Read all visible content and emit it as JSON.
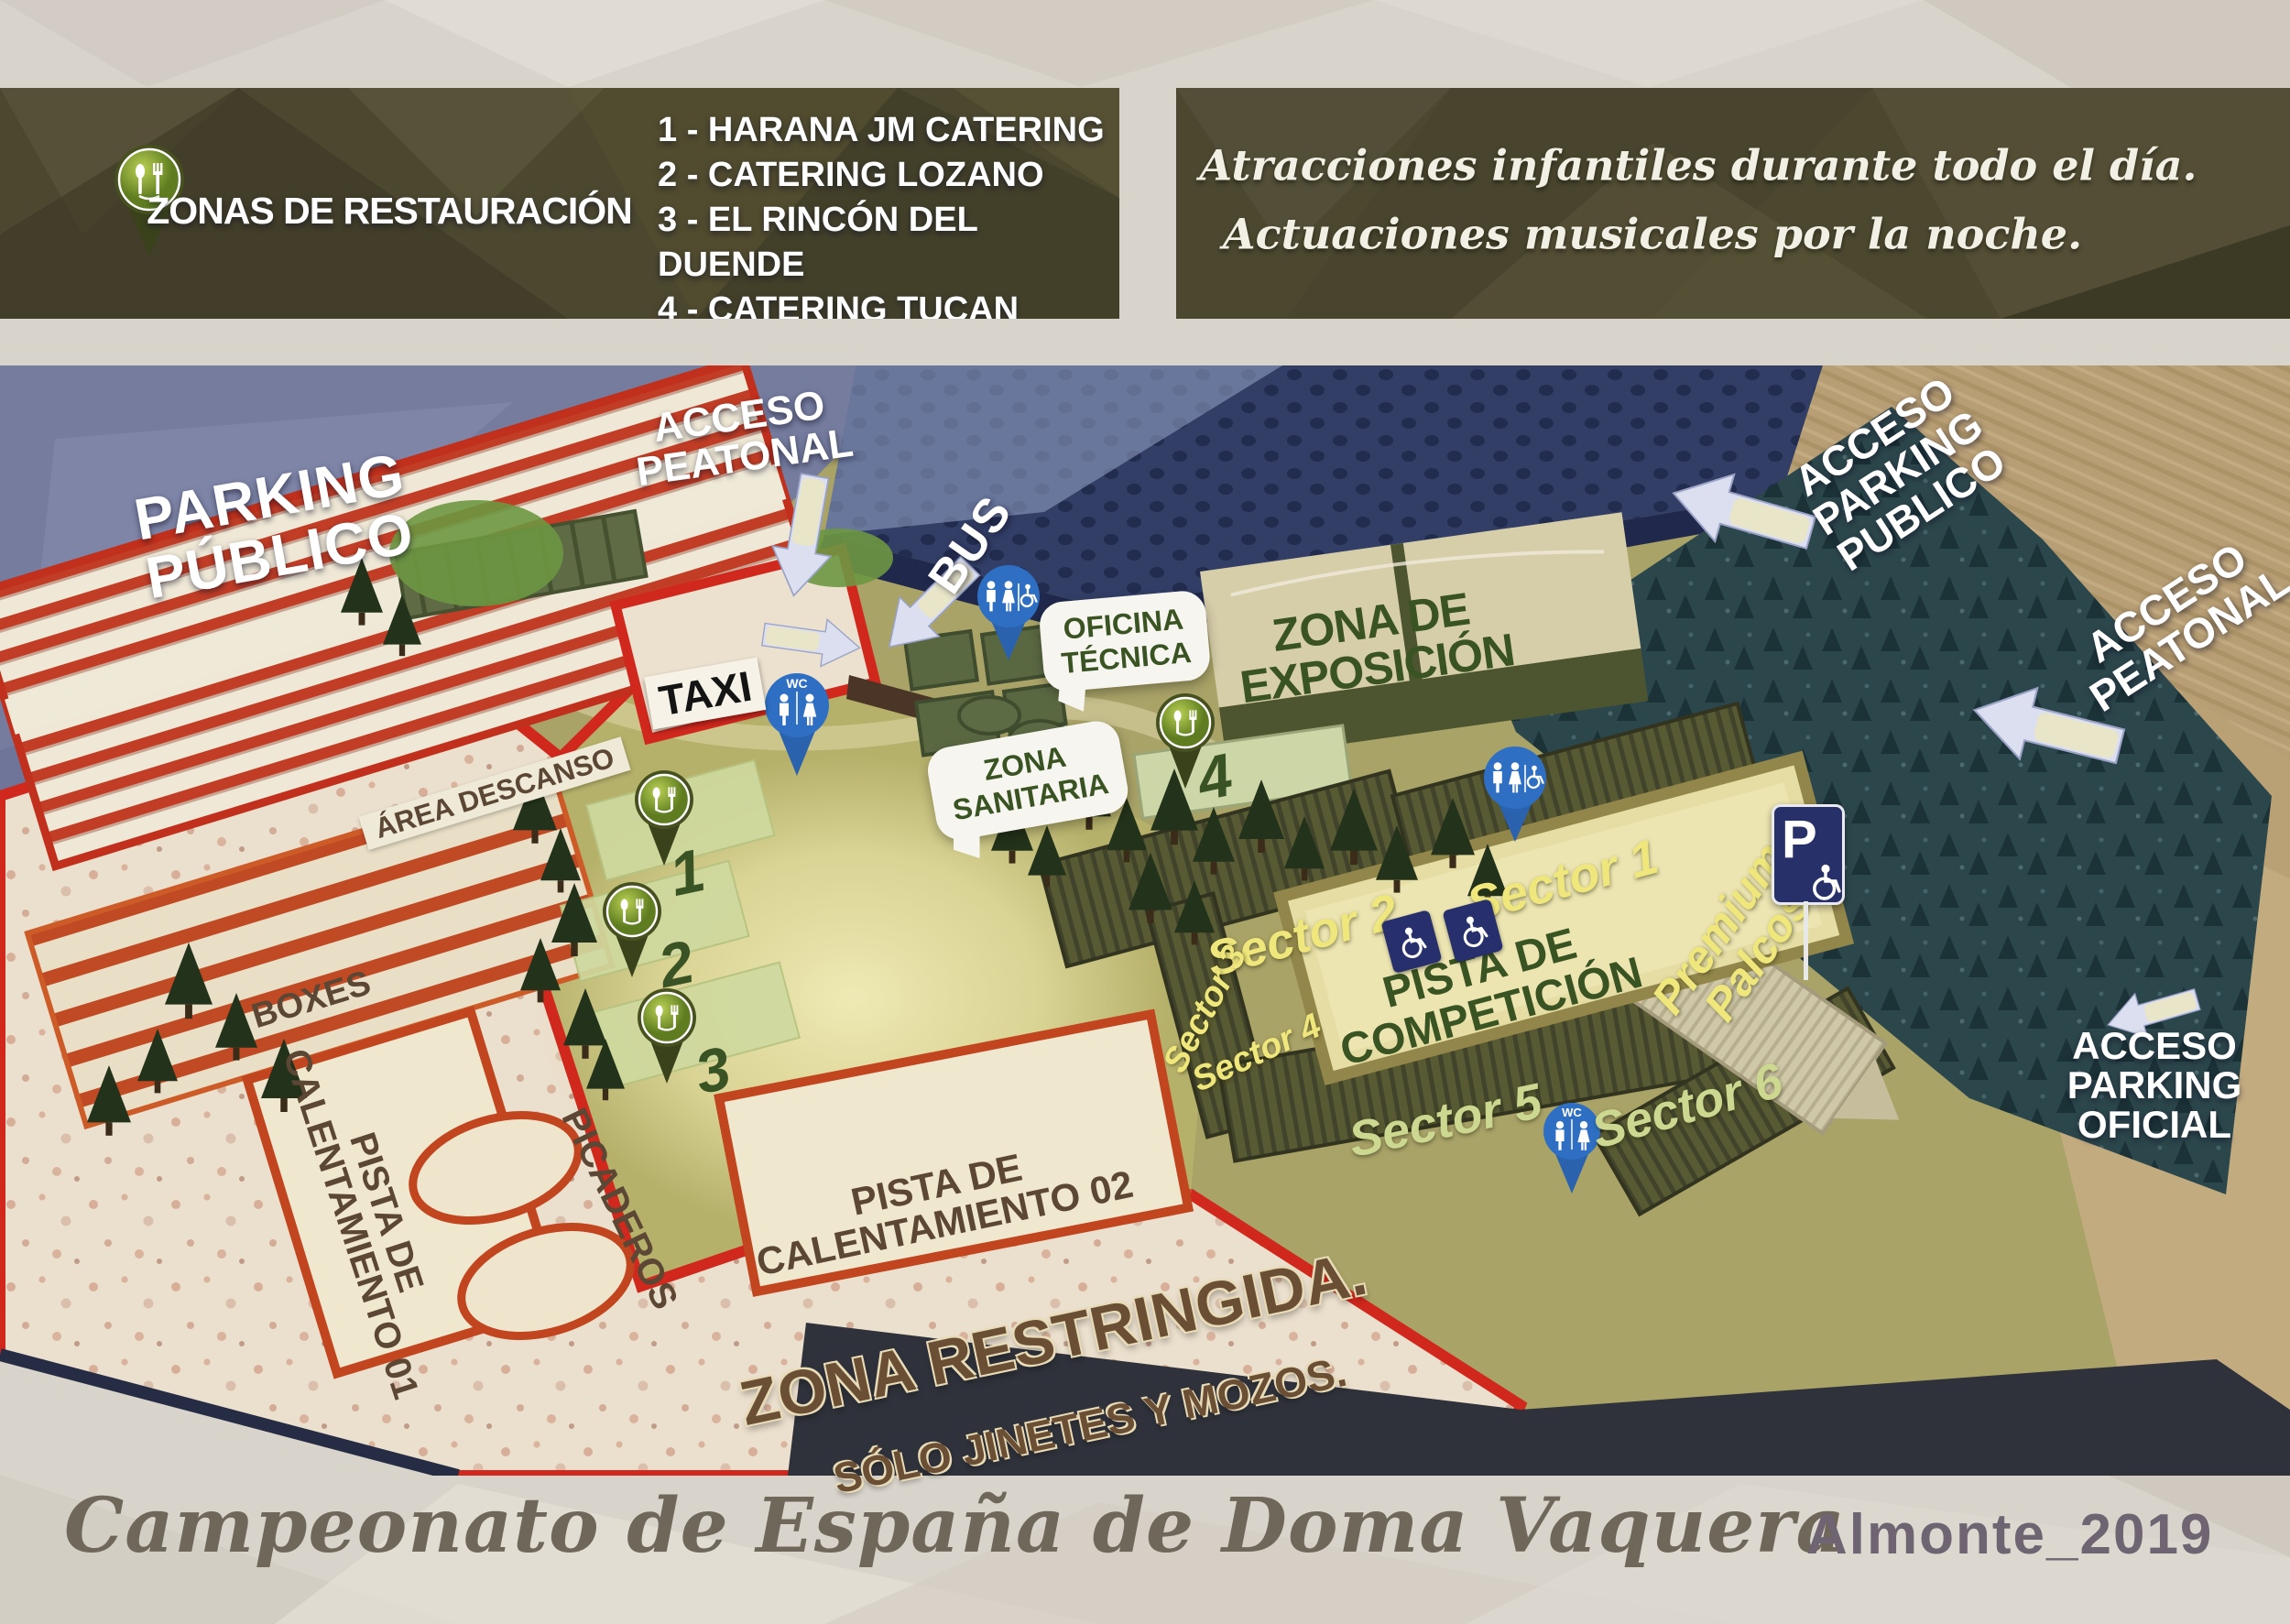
{
  "legend": {
    "title": "ZONAS DE RESTAURACIÓN",
    "items": [
      "1 - HARANA JM CATERING",
      "2 - CATERING LOZANO",
      "3 - EL RINCÓN DEL DUENDE",
      "4 - CATERING TUCAN"
    ]
  },
  "notice": {
    "line1": "Atracciones infantiles durante todo el día.",
    "line2": "Actuaciones musicales por la noche."
  },
  "map": {
    "areas": {
      "parking1": "PARKING",
      "parking2": "PÚBLICO",
      "acceso": "ACCESO",
      "peatonal": "PEATONAL",
      "bus": "BUS",
      "taxi": "TAXI",
      "oficina1": "OFICINA",
      "oficina2": "TÉCNICA",
      "expo1": "ZONA DE",
      "expo2": "EXPOSICIÓN",
      "sanitaria1": "ZONA",
      "sanitaria2": "SANITARIA",
      "area_descanso": "ÁREA DESCANSO",
      "boxes": "BOXES",
      "picaderos": "PICADEROS",
      "pista": "PISTA DE",
      "calentamiento01": "CALENTAMIENTO 01",
      "calentamiento02": "CALENTAMIENTO 02",
      "competicion": "COMPETICIÓN",
      "restringida": "ZONA RESTRINGIDA.",
      "solo_jinetes": "SÓLO JINETES Y MOZOS.",
      "premium1": "Premium",
      "premium2": "Palcos",
      "parking_word": "PARKING",
      "publico_word": "PUBLICO",
      "oficial_word": "OFICIAL"
    },
    "sectors": [
      "Sector 1",
      "Sector 2",
      "Sector 3",
      "Sector 4",
      "Sector 5",
      "Sector 6"
    ],
    "pins": {
      "wc": "WC",
      "parking_sign": "P",
      "catering": [
        "1",
        "2",
        "3",
        "4"
      ]
    }
  },
  "footer": {
    "title": "Campeonato de España de Doma Vaquera",
    "edition": "Almonte_2019"
  },
  "colors": {
    "banner_olive": "#4c4830",
    "map_red": "#d1281e",
    "pin_blue": "#2e6fc3",
    "catering_green": "#7b9a33",
    "sand": "#efe6cf",
    "forest_teal": "#2c474c",
    "parking_blue": "#757c9e",
    "arena_sand": "#e5dda4",
    "label_green": "#3a5322",
    "label_brown": "#5b4733",
    "sector_yellow": "#efe77c",
    "sector_light": "#ccd88f"
  }
}
